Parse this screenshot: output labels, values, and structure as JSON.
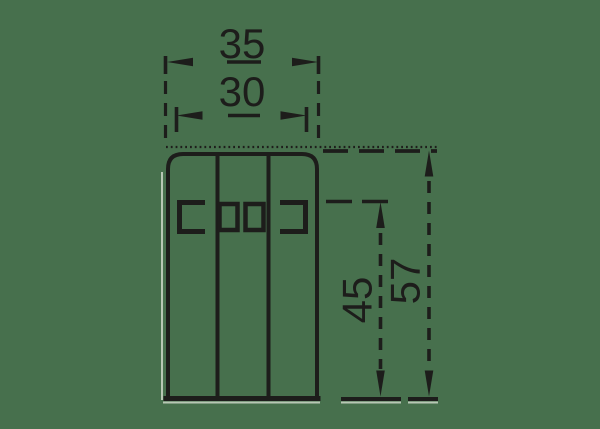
{
  "drawing": {
    "kind": "technical-dimension-drawing",
    "dimensions": {
      "width_overall": "35",
      "slot_width": "30",
      "slot_to_base_height": "45",
      "height_overall": "57"
    },
    "colors": {
      "background": "#47704d",
      "line": "#1d1d1b",
      "shadow_highlight": "#ccd6c8"
    }
  }
}
